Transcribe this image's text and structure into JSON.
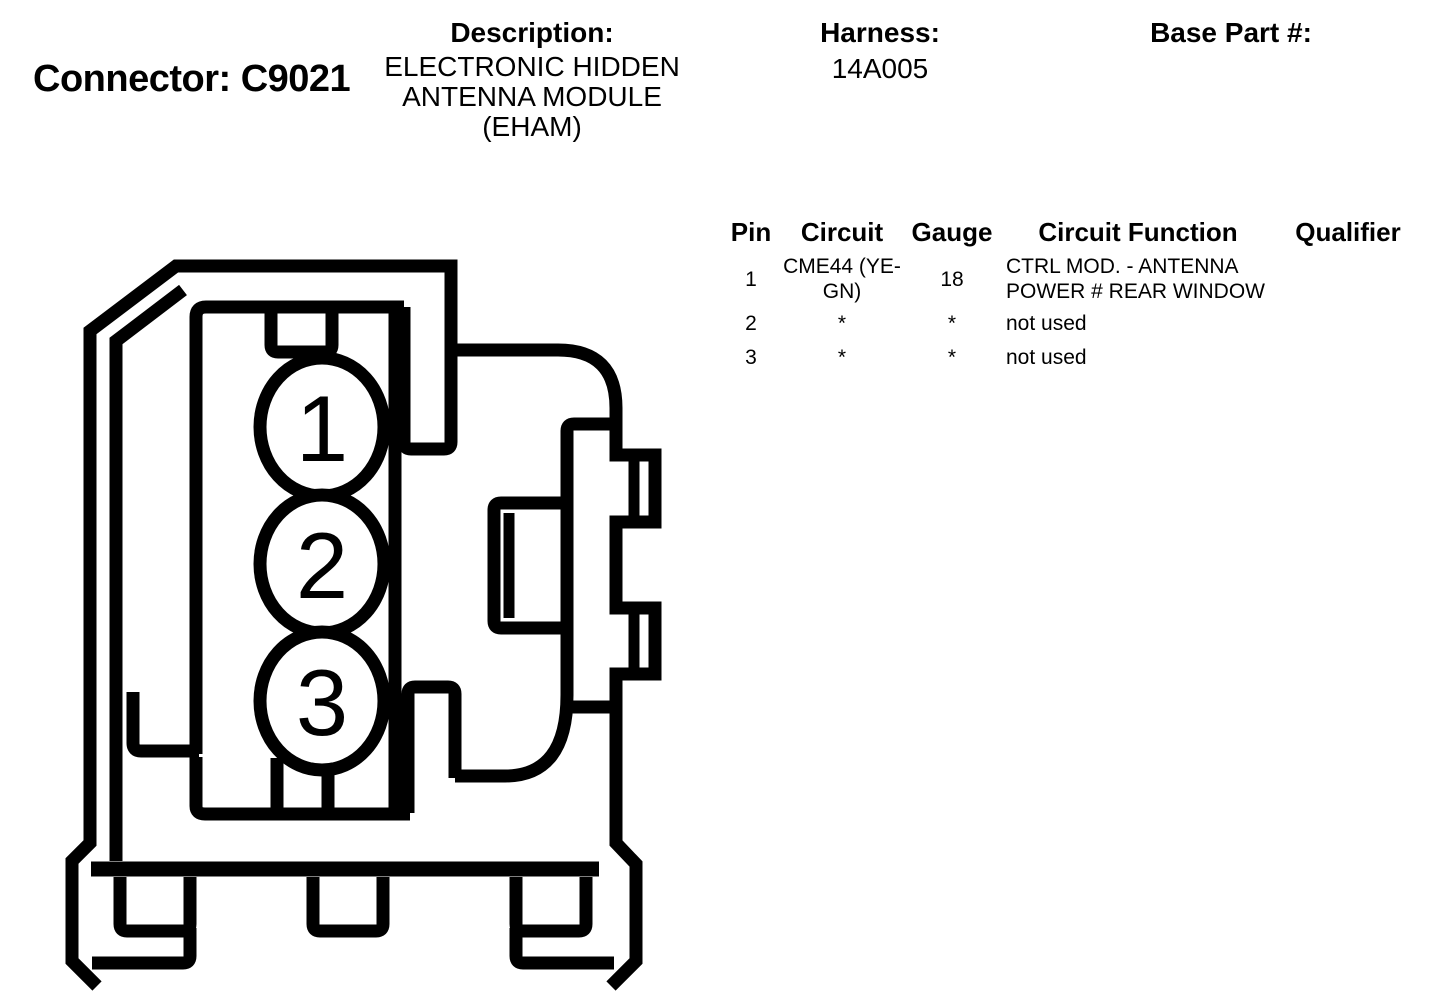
{
  "page": {
    "background": "#ffffff",
    "text_color": "#000000"
  },
  "header": {
    "connector_title": "Connector: C9021",
    "description": {
      "label": "Description:",
      "value": "ELECTRONIC HIDDEN ANTENNA MODULE (EHAM)"
    },
    "harness": {
      "label": "Harness:",
      "value": "14A005"
    },
    "base_part": {
      "label": "Base Part #:",
      "value": ""
    }
  },
  "pin_table": {
    "columns": [
      "Pin",
      "Circuit",
      "Gauge",
      "Circuit Function",
      "Qualifier"
    ],
    "rows": [
      {
        "pin": "1",
        "circuit": "CME44 (YE-GN)",
        "gauge": "18",
        "circuit_function": "CTRL MOD. - ANTENNA POWER # REAR WINDOW",
        "qualifier": ""
      },
      {
        "pin": "2",
        "circuit": "*",
        "gauge": "*",
        "circuit_function": "not used",
        "qualifier": ""
      },
      {
        "pin": "3",
        "circuit": "*",
        "gauge": "*",
        "circuit_function": "not used",
        "qualifier": ""
      }
    ]
  },
  "diagram": {
    "name": "connector-face-view",
    "pins": [
      "1",
      "2",
      "3"
    ],
    "line_color": "#000000",
    "fill_color": "#ffffff"
  }
}
